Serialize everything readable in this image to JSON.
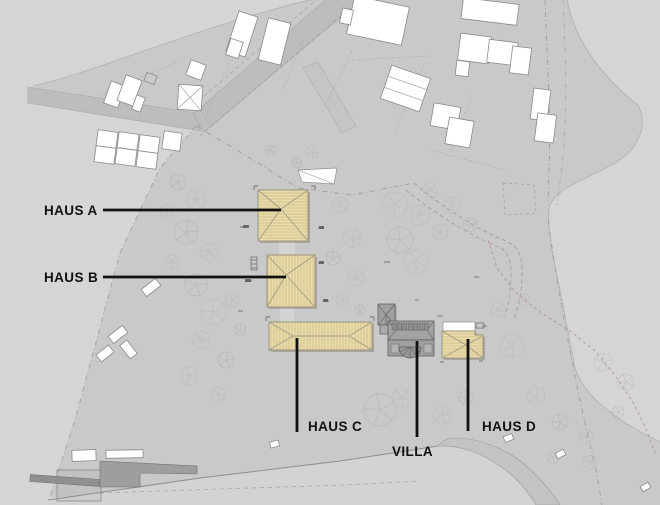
{
  "plan": {
    "labels": {
      "haus_a": "HAUS A",
      "haus_b": "HAUS B",
      "haus_c": "HAUS C",
      "villa": "VILLA",
      "haus_d": "HAUS D"
    },
    "colors": {
      "background": "#d5d5d5",
      "site": "#c9c9c9",
      "road": "#bdbdbd",
      "light_area": "#d3d3d3",
      "highlight_building": "#e9dcab",
      "highlight_edge": "#9b947d",
      "villa_gray": "#a2a2a2",
      "white_building": "#ffffff",
      "label_text": "#111111"
    }
  }
}
